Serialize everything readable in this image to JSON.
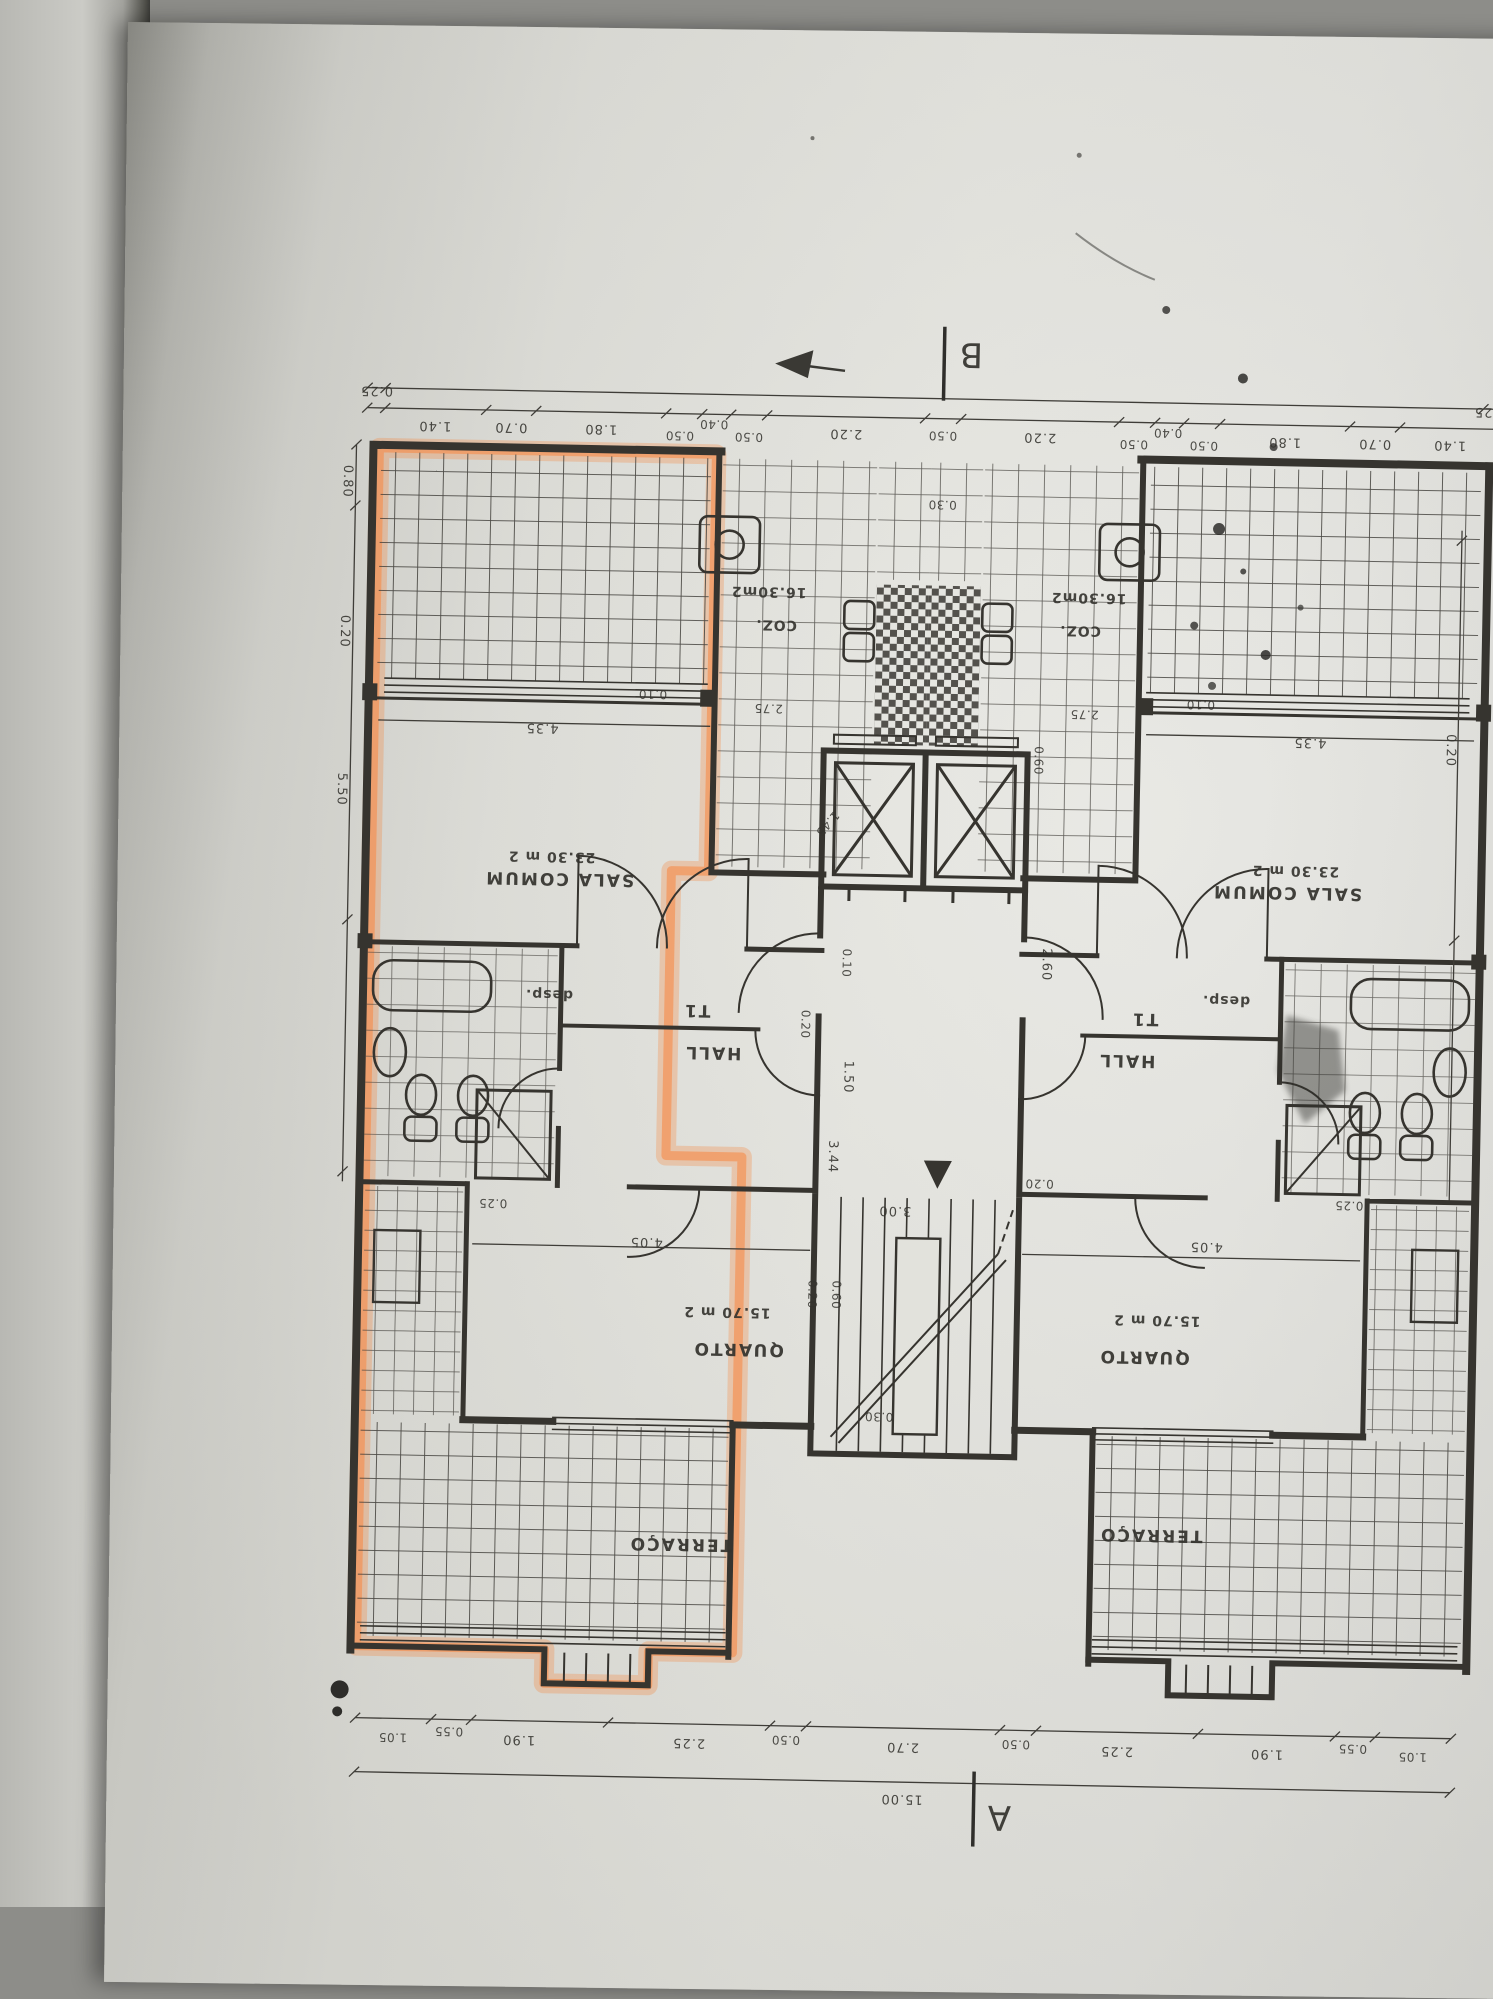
{
  "document": {
    "type": "architectural floor plan photo, rotated 180°",
    "highlight_color": "#f78a48",
    "paper_color": "#e2e2dc",
    "line_color": "#3a3833"
  },
  "markers": {
    "b": "B",
    "a": "A"
  },
  "rooms": {
    "sala": {
      "name": "SALA COMUM",
      "area": "23.30 m 2"
    },
    "cozinha": {
      "name": "COZ.",
      "area": "16.30m2"
    },
    "hall": {
      "name": "HALL",
      "unit": "T1"
    },
    "desp": {
      "name": "desp."
    },
    "quarto": {
      "name": "QUARTO",
      "area": "15.70 m 2"
    },
    "terraco": {
      "name": "TERRAÇO"
    }
  },
  "dims": {
    "top_left_end": "0.25",
    "top_right_end": "0.25",
    "top_chain": [
      "1.40",
      "0.70",
      "1.80",
      "0.50",
      "0.40",
      "0.50",
      "2.20",
      "0.50",
      "2.20",
      "0.50",
      "0.40",
      "0.50",
      "1.80",
      "0.70",
      "1.40"
    ],
    "bottom_chain": [
      "1.05",
      "0.55",
      "1.90",
      "2.25",
      "0.50",
      "2.70",
      "0.50",
      "2.25",
      "1.90",
      "0.55",
      "1.05"
    ],
    "bottom_total": "15.00",
    "left_side": [
      "0.80",
      "0.20",
      "5.50"
    ],
    "right_side_wall": "0.20",
    "sala_width": "4.35",
    "sala_gap": "0.10",
    "coz_width": "2.75",
    "parapet": "0.30",
    "shaft": "1.45",
    "shaft_gap": "0.10",
    "corridor": "1.50",
    "hall_wall": "0.20",
    "entry": "2.60",
    "vent": "0.60",
    "stair_width": "3.00",
    "stair_run": "3.44",
    "stair_wall": "0.20",
    "quarto_width": "4.05",
    "quarto_wall": "0.25",
    "q1": "0.20",
    "q2": "0.60",
    "q3": "0.30"
  }
}
